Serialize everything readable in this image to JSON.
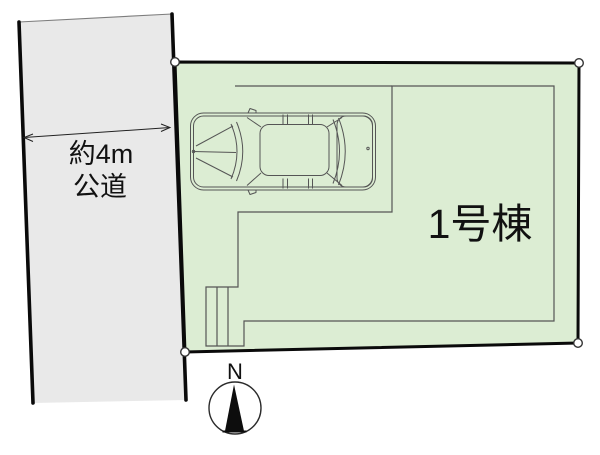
{
  "road": {
    "width_label": "約4m",
    "type_label": "公道",
    "fill_color": "#e9e9e9"
  },
  "plot": {
    "building_label": "1号棟",
    "fill_color": "#dcedd3"
  },
  "compass": {
    "north_label": "N"
  },
  "colors": {
    "boundary_black": "#0a0a0a",
    "building_outline_gray": "#555555"
  }
}
